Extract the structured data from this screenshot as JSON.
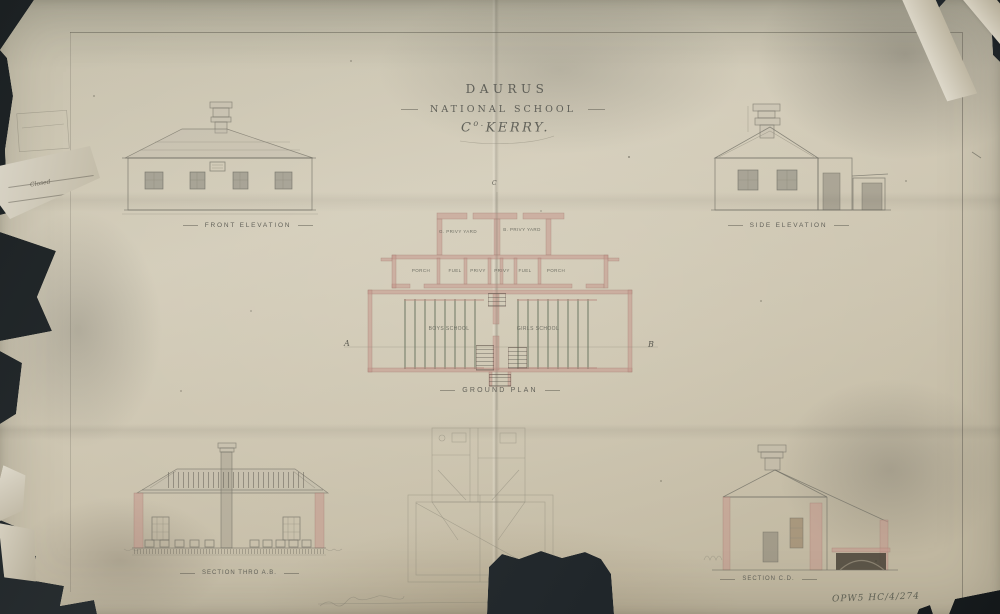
{
  "sheet": {
    "title": {
      "line1": "DAURUS",
      "line2": "NATIONAL SCHOOL",
      "county_prefix": "C",
      "county_sup": "o.",
      "county_name": "KERRY."
    },
    "labels": {
      "front_elevation": "FRONT ELEVATION",
      "side_elevation": "SIDE ELEVATION",
      "ground_plan": "GROUND PLAN",
      "section_ab": "SECTION THRO A.B.",
      "section_cd": "SECTION C.D."
    },
    "plan": {
      "yard_left": "G. PRIVY YARD",
      "yard_right": "B. PRIVY YARD",
      "rooms": [
        "PORCH",
        "FUEL",
        "PRIVY",
        "PRIVY",
        "FUEL",
        "PORCH"
      ],
      "boys_school": "BOYS SCHOOL",
      "girls_school": "GIRLS SCHOOL",
      "marker_a": "A",
      "marker_b": "B",
      "marker_c": "C"
    },
    "annotations": {
      "edge_note": "Closed",
      "archive_ref": "OPW5 HC/4/274"
    },
    "colors": {
      "paper": "#cdc5b1",
      "backdrop": "#22282b",
      "pencil": "#6e6c62",
      "wall_wash": "#c5988c"
    }
  }
}
